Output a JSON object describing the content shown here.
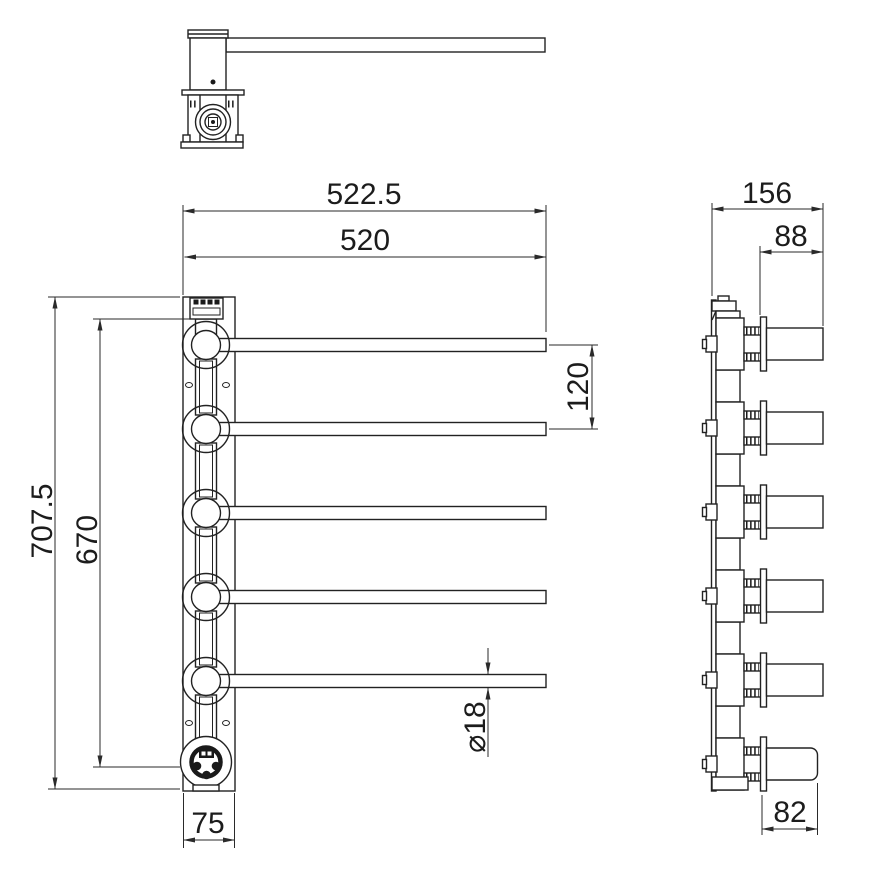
{
  "drawing": {
    "background_color": "#ffffff",
    "line_color": "#222222",
    "dimensions": {
      "overall_width": "522.5",
      "rail_length": "520",
      "overall_height": "707.5",
      "mounting_height": "670",
      "arm_spacing": "120",
      "bar_diameter": "⌀18",
      "plate_width": "75",
      "side_overall_depth": "156",
      "arm_projection": "88",
      "bottom_arm_projection": "82"
    }
  }
}
